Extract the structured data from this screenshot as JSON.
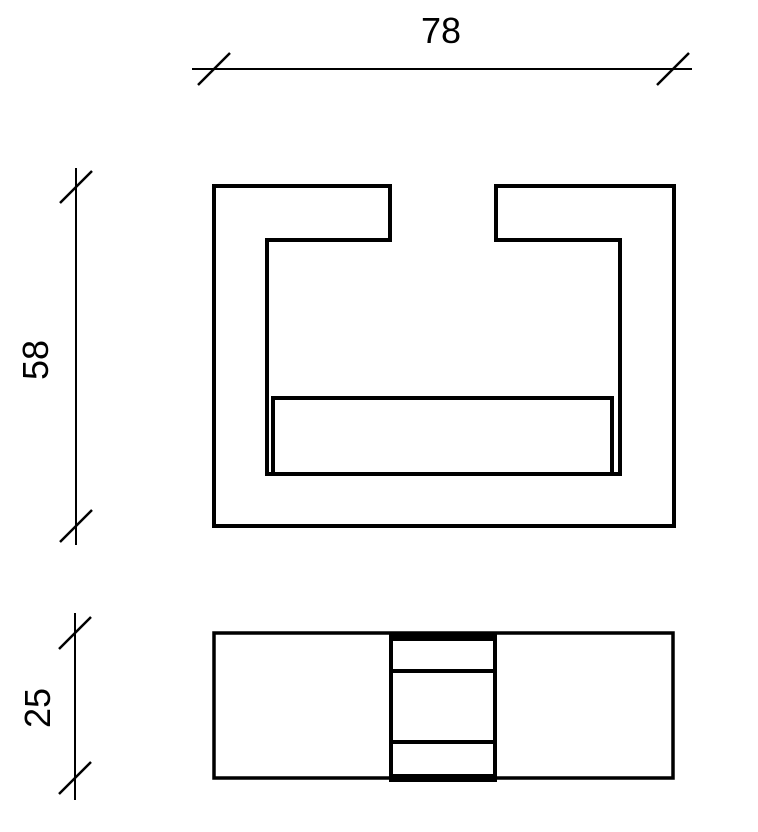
{
  "drawing": {
    "type": "2D orthographic technical drawing",
    "background_color": "#ffffff",
    "line_color": "#000000",
    "views": [
      {
        "id": "front",
        "name": "front-view-c-channel-profile-with-insert"
      },
      {
        "id": "top",
        "name": "top-view-plan-with-center-slot"
      }
    ],
    "dimensions": [
      {
        "id": "overall-width",
        "label": "78",
        "orientation": "horizontal",
        "applies_to": "front"
      },
      {
        "id": "overall-height",
        "label": "58",
        "orientation": "vertical",
        "applies_to": "front"
      },
      {
        "id": "depth",
        "label": "25",
        "orientation": "vertical",
        "applies_to": "top"
      }
    ]
  }
}
